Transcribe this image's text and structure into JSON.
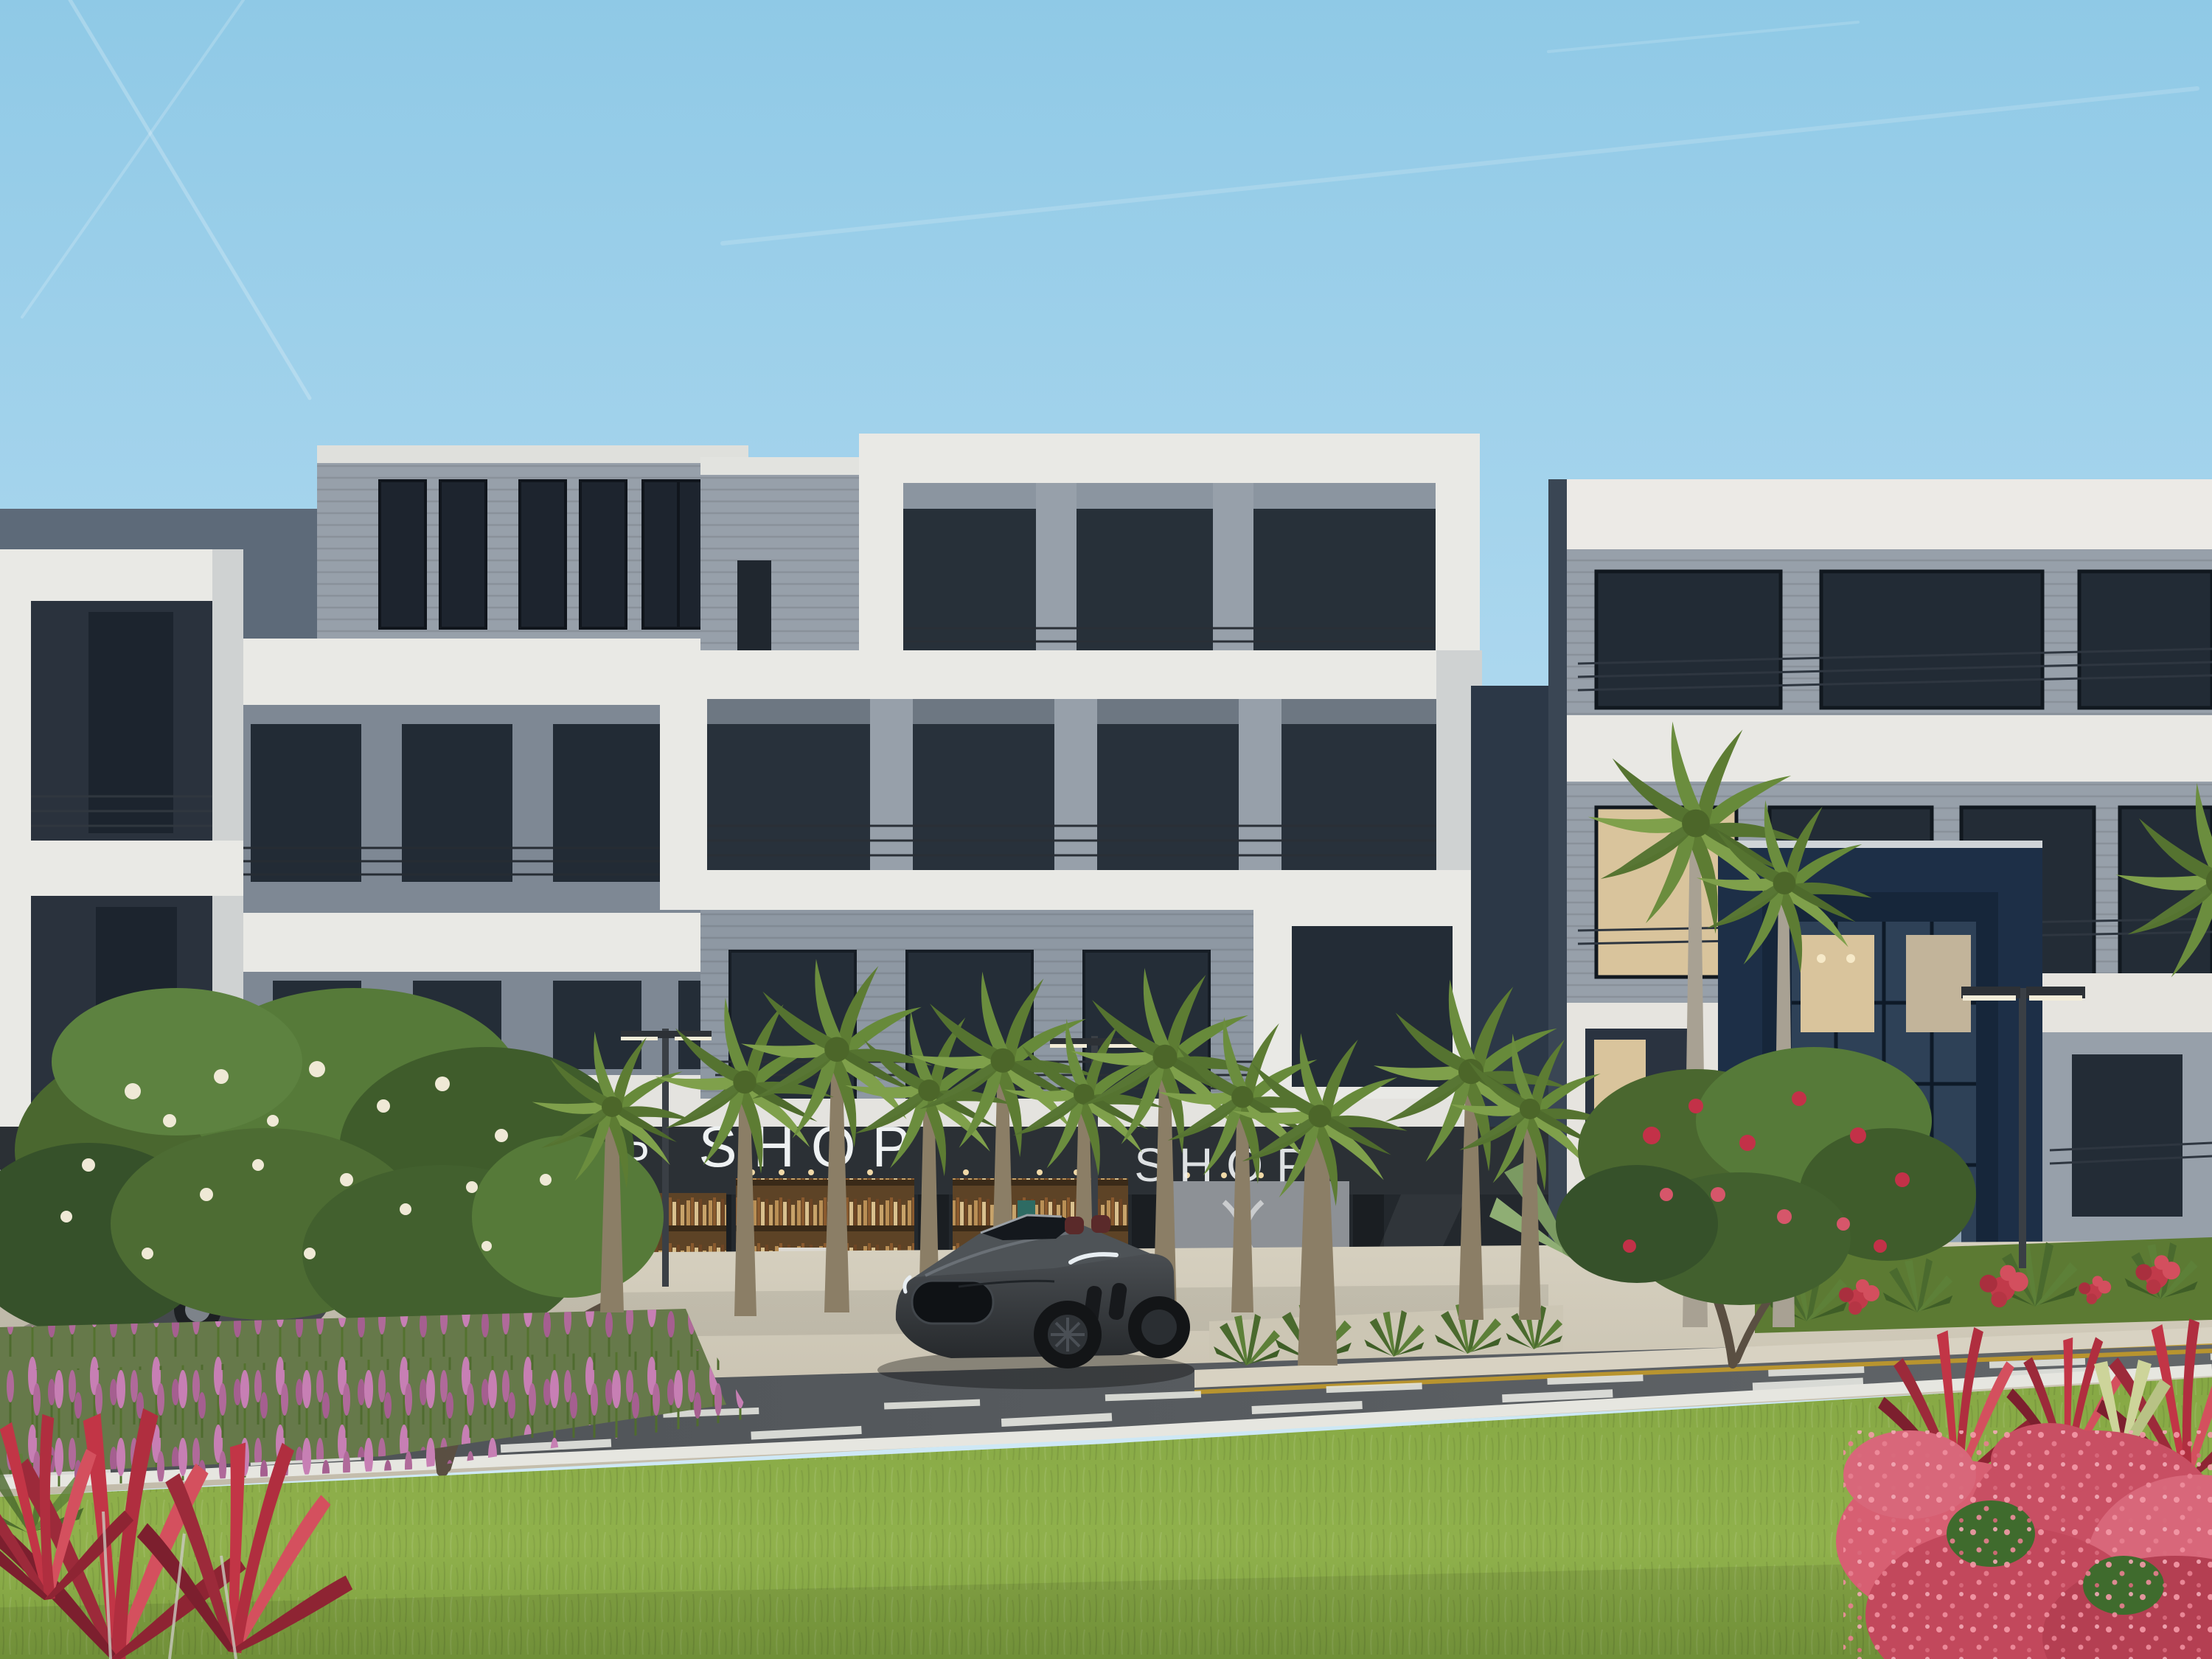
{
  "signs": {
    "cafe": "CAFE",
    "shop_left": "SHOP",
    "shop_center": "SHOP",
    "shop_right": "SHOP"
  },
  "colors": {
    "sky_top": "#8fc9e6",
    "sky_mid": "#b5dcf1",
    "sky_horizon": "#d8edf7",
    "facade_white": "#e9e9e5",
    "facade_white_shade": "#cfd2d2",
    "facade_gray": "#97a0aa",
    "facade_gray_dark": "#7d8793",
    "wall_slate": "#5d6a79",
    "wall_navy": "#2c3847",
    "portal_navy": "#1d2f47",
    "glass_dark": "#232c36",
    "glass_reflection": "#46586b",
    "storefront_dark": "#2b3035",
    "sign_white": "#eef1f2",
    "cafe_sign": "#b9bec2",
    "bookshelf_wood": "#5d4326",
    "pavement": "#cfc8b6",
    "curb": "#d8d2c2",
    "asphalt": "#54585c",
    "marking_white": "#e3e4de",
    "marking_yellow": "#c2a23d",
    "grass": "#86a844",
    "grass_dark": "#5e7f31",
    "palm_green": "#6d8f3f",
    "palm_trunk": "#8b7e66",
    "foliage_green": "#4a672f",
    "plumeria_white": "#efe9d6",
    "plumeria_red": "#c33148",
    "salvia_pink": "#b06a9a",
    "ixora_pink": "#d75f72",
    "cordyline_red": "#bf3344",
    "car_dark": "#3c4044",
    "suv_gray": "#45494d",
    "lamp_glow": "#f3ecd8",
    "interior_warm": "#d9c49c"
  }
}
